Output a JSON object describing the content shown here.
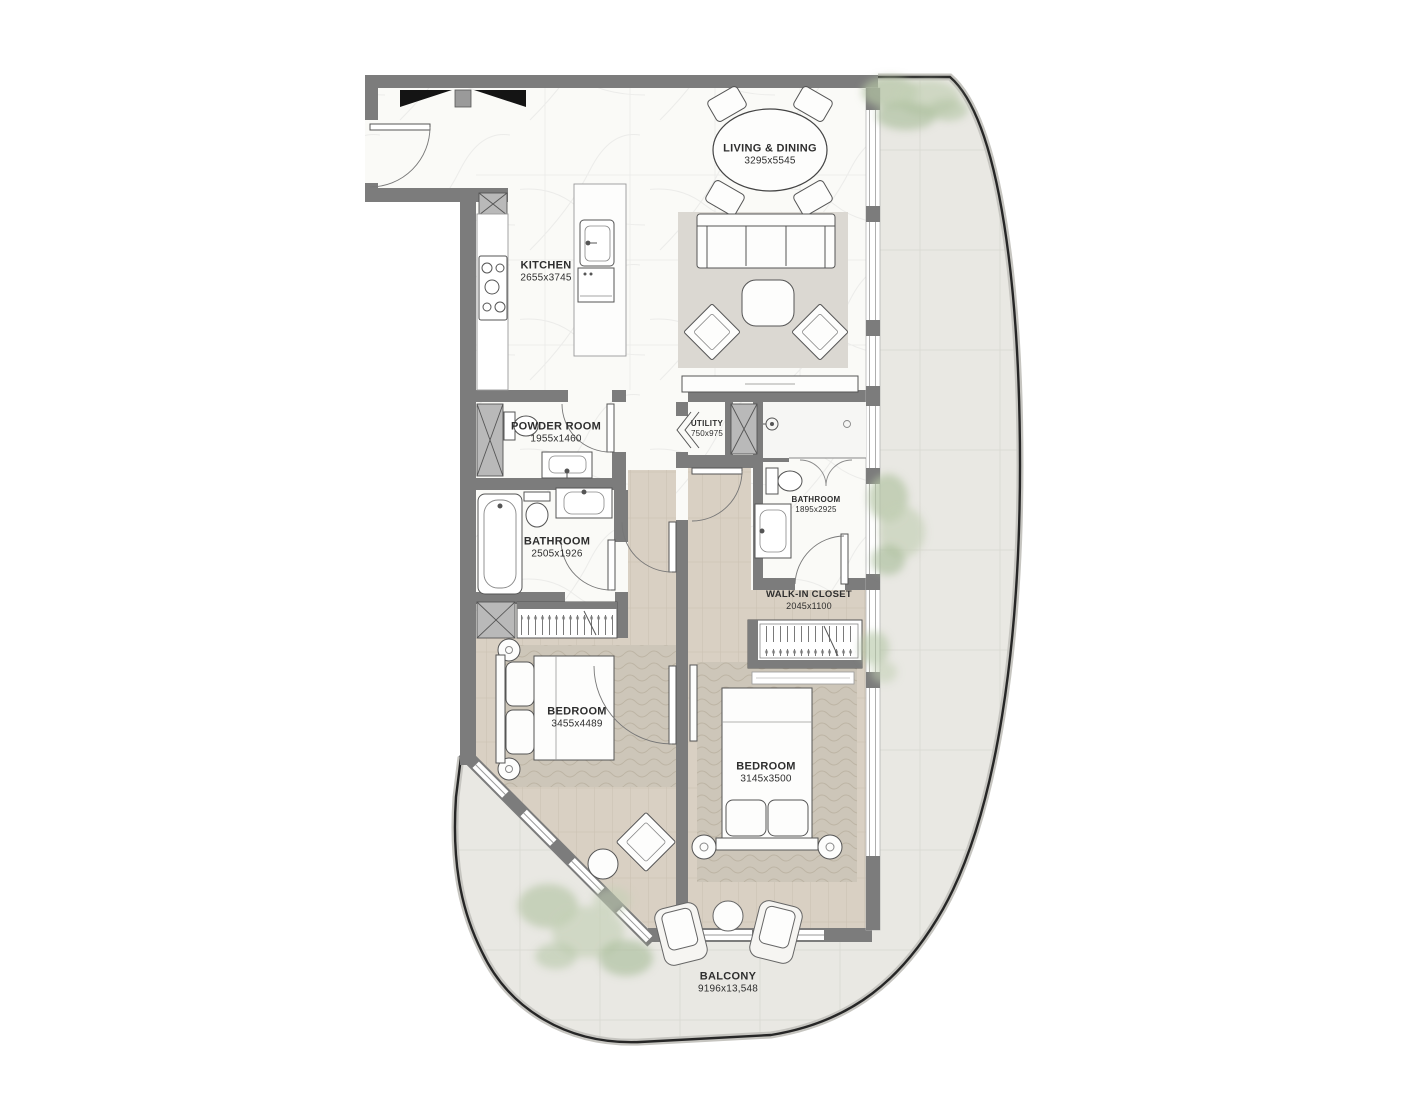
{
  "floor_plan": {
    "rooms": [
      {
        "id": "living-dining",
        "name": "LIVING & DINING",
        "dimensions": "3295x5545"
      },
      {
        "id": "kitchen",
        "name": "KITCHEN",
        "dimensions": "2655x3745"
      },
      {
        "id": "powder-room",
        "name": "POWDER ROOM",
        "dimensions": "1955x1460"
      },
      {
        "id": "utility",
        "name": "UTILITY",
        "dimensions": "750x975"
      },
      {
        "id": "bathroom-main",
        "name": "BATHROOM",
        "dimensions": "1895x2925"
      },
      {
        "id": "bathroom-guest",
        "name": "BATHROOM",
        "dimensions": "2505x1926"
      },
      {
        "id": "walk-in-closet",
        "name": "WALK-IN CLOSET",
        "dimensions": "2045x1100"
      },
      {
        "id": "bedroom-1",
        "name": "BEDROOM",
        "dimensions": "3455x4489"
      },
      {
        "id": "bedroom-2",
        "name": "BEDROOM",
        "dimensions": "3145x3500"
      },
      {
        "id": "balcony",
        "name": "BALCONY",
        "dimensions": "9196x13,548"
      }
    ],
    "colors": {
      "wall": "#7c7c7c",
      "balcony_floor": "#e9e8e3",
      "wood_floor": "#d9d0c3",
      "marble_floor": "#fafaf7",
      "rug": "#cdc6b9",
      "railing": "#262626",
      "greenery": "#b3c4a4",
      "label_text": "#2e2e2e"
    }
  }
}
